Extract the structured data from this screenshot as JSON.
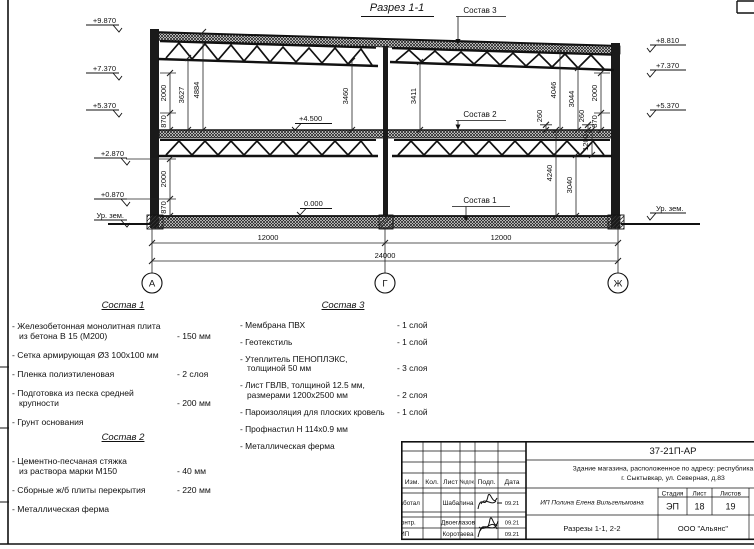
{
  "drawing": {
    "title": "Разрез 1-1",
    "callout_1": "Состав 1",
    "callout_2": "Состав 2",
    "callout_3": "Состав 3",
    "levels": {
      "left": [
        "+9.870",
        "+7.370",
        "+5.370",
        "+2.870",
        "+0.870",
        "Ур. зем."
      ],
      "right": [
        "+8.810",
        "+7.370",
        "+5.370",
        "Ур. зем."
      ],
      "mid_floor": "+4.500",
      "ground_floor": "0.000"
    },
    "dims": {
      "left_870a": "870",
      "left_2000a": "2000",
      "left_3627": "3627",
      "left_4884": "4884",
      "left_2000b": "2000",
      "left_870b": "870",
      "mid_3460": "3460",
      "mid_3411": "3411",
      "right_260a": "260",
      "right_4046": "4046",
      "right_3044": "3044",
      "right_260b": "260",
      "right_870": "870",
      "right_2000": "2000",
      "right_4240": "4240",
      "right_3040": "3040",
      "right_1200": "1200",
      "bottom_left": "12000",
      "bottom_right": "12000",
      "bottom_total": "24000"
    },
    "axes": [
      "А",
      "Г",
      "Ж"
    ]
  },
  "compositions": [
    {
      "title": "Состав 1",
      "items": [
        {
          "name": "- Железобетонная  монолитная плита\nиз бетона В 15 (М200)",
          "qty": "- 150 мм"
        },
        {
          "name": "- Сетка армирующая Ø3 100х100 мм",
          "qty": ""
        },
        {
          "name": "- Пленка полиэтиленовая",
          "qty": "- 2 слоя"
        },
        {
          "name": "- Подготовка из песка средней\nкрупности",
          "qty": "- 200 мм"
        },
        {
          "name": "- Грунт основания",
          "qty": ""
        }
      ]
    },
    {
      "title": "Состав 2",
      "items": [
        {
          "name": "- Цементно-песчаная стяжка\nиз раствора марки М150",
          "qty": "- 40 мм"
        },
        {
          "name": "- Сборные ж/б плиты перекрытия",
          "qty": "- 220 мм"
        },
        {
          "name": "- Металлическая ферма",
          "qty": ""
        }
      ]
    },
    {
      "title": "Состав 3",
      "items": [
        {
          "name": "- Мембрана ПВХ",
          "qty": "- 1 слой"
        },
        {
          "name": "- Геотекстиль",
          "qty": "- 1 слой"
        },
        {
          "name": "- Утеплитель ПЕНОПЛЭКС,\nтолщиной 50 мм",
          "qty": "- 3 слоя"
        },
        {
          "name": "- Лист ГВЛВ, толщиной 12.5 мм,\nразмерами 1200х2500 мм",
          "qty": "- 2 слоя"
        },
        {
          "name": "- Пароизоляция для плоских кровель",
          "qty": "- 1 слой"
        },
        {
          "name": "- Профнастил Н 114х0.9 мм",
          "qty": ""
        },
        {
          "name": "- Металлическая ферма",
          "qty": ""
        }
      ]
    }
  ],
  "title_block": {
    "doc_number": "37-21П-АР",
    "project_line1": "Здание магазина, расположенное по адресу: республика Коми,",
    "project_line2": "г. Сыктывкар, ул. Северная, д.83",
    "columns": [
      "Изм.",
      "Кол.",
      "Лист",
      "№док.",
      "Подп.",
      "Дата"
    ],
    "rows": [
      {
        "role": "Разработал",
        "name": "Шабалина",
        "date": "09.21"
      },
      {
        "role": "Н. контр.",
        "name": "Двоеглазов",
        "date": "09.21"
      },
      {
        "role": "ГИП",
        "name": "Коротаева",
        "date": "09.21"
      }
    ],
    "client": "ИП Полина Елена Вильгельмовна",
    "stage_label": "Стадия",
    "sheet_label": "Лист",
    "sheets_label": "Листов",
    "stage": "ЭП",
    "sheet": "18",
    "sheets": "19",
    "sheet_title": "Разрезы 1-1, 2-2",
    "company": "ООО \"Альянс\""
  }
}
